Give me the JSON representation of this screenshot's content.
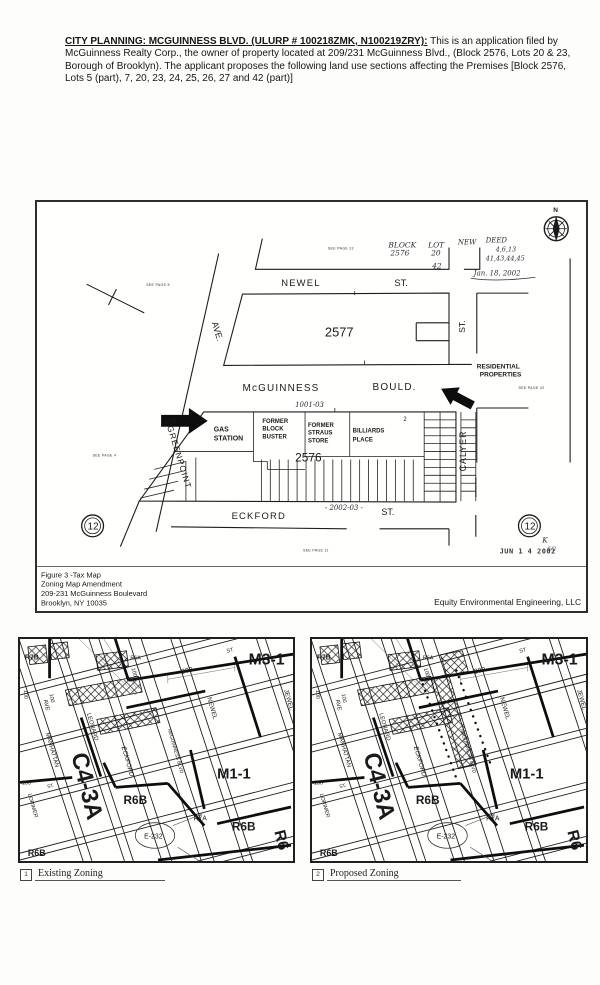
{
  "colors": {
    "paper": "#fdfdfc",
    "ink": "#1a1a1a"
  },
  "header": {
    "title": "CITY PLANNING: MCGUINNESS BLVD. (ULURP # 100218ZMK, N100219ZRY):",
    "body": " This is an application filed by McGuinness Realty Corp., the owner of property located at 209/231 McGuinness Blvd., (Block 2576, Lots 20 & 23, Borough of Brooklyn). The applicant proposes the following land use sections affecting the Premises [Block 2576, Lots 5 (part), 7, 20, 23, 24, 25, 26, 27 and 42 (part)]"
  },
  "tax_map": {
    "streets": {
      "newel": "NEWEL",
      "newel_st": "ST.",
      "mcguinness": "McGUINNESS",
      "bould": "BOULD.",
      "eckford": "ECKFORD",
      "eckford_st": "ST.",
      "calyer": "CALYER",
      "calyer_st": "ST.",
      "ave": "AVE.",
      "greenpoint": "GREENPOINT"
    },
    "blocks": {
      "b2577": "2577",
      "b2576": "2576",
      "billiards_lot_no": "2"
    },
    "places": {
      "gas1": "GAS",
      "gas2": "STATION",
      "fb1": "FORMER",
      "fb2": "BLOCK",
      "fb3": "BUSTER",
      "fs1": "FORMER",
      "fs2": "STRAUS",
      "fs3": "STORE",
      "bil1": "BILLIARDS",
      "bil2": "PLACE",
      "res1": "RESIDENTIAL",
      "res2": "PROPERTIES"
    },
    "notes": {
      "p8": "SEE PAGE 8",
      "p13": "SEE PAGE 13",
      "p4": "SEE PAGE 4",
      "p42": "SEE PAGE 42",
      "p11": "SEE PAGE 11"
    },
    "hand": {
      "block": "BLOCK",
      "block_no": "2576",
      "lot": "LOT",
      "lot_no": "20",
      "lot42": "42",
      "neww": "NEW",
      "deed": "DEED",
      "d1": "4,6,13",
      "d2": "41,43,44,45",
      "date": "Jan. 18, 2002",
      "note_top": "1001-03",
      "note_bottom": "- 2002-03 -",
      "k": "K",
      "k2": "6/2"
    },
    "stamp": "JUN 1 4 2002",
    "site": "SITE",
    "compass_n": "N",
    "page_circle": "12",
    "caption": {
      "l1": "Figure 3 -Tax Map",
      "l2": "Zoning Map Amendment",
      "l3": "209-231 McGuinness Boulevard",
      "l4": "Brooklyn, NY 10035"
    },
    "company": "Equity Environmental Engineering, LLC"
  },
  "zoning": {
    "labels": {
      "r7b": "R7B",
      "r6a": "R6A",
      "m3_1": "M3-1",
      "st_a": "ST",
      "st_b": "ST.",
      "n300": "-300-",
      "v100": "100",
      "v150": "150",
      "ave": "AVE",
      "manhattan": "MANHATTAN",
      "leonard": "LEONARD",
      "eckford": "ECKFORD",
      "mcguinness": "McGUINNESS BLVD",
      "newel": "NEWEL",
      "jewel": "JEWEL",
      "c4_3a": "C4-3A",
      "m1_1": "M1-1",
      "r6b": "R6B",
      "r7a": "R7A",
      "e232": "E-232",
      "lorimer": "LORIMER",
      "r6_part": "R6"
    },
    "captions": {
      "existing": {
        "num": "1",
        "label": "Existing Zoning"
      },
      "proposed": {
        "num": "2",
        "label": "Proposed Zoning"
      }
    }
  }
}
